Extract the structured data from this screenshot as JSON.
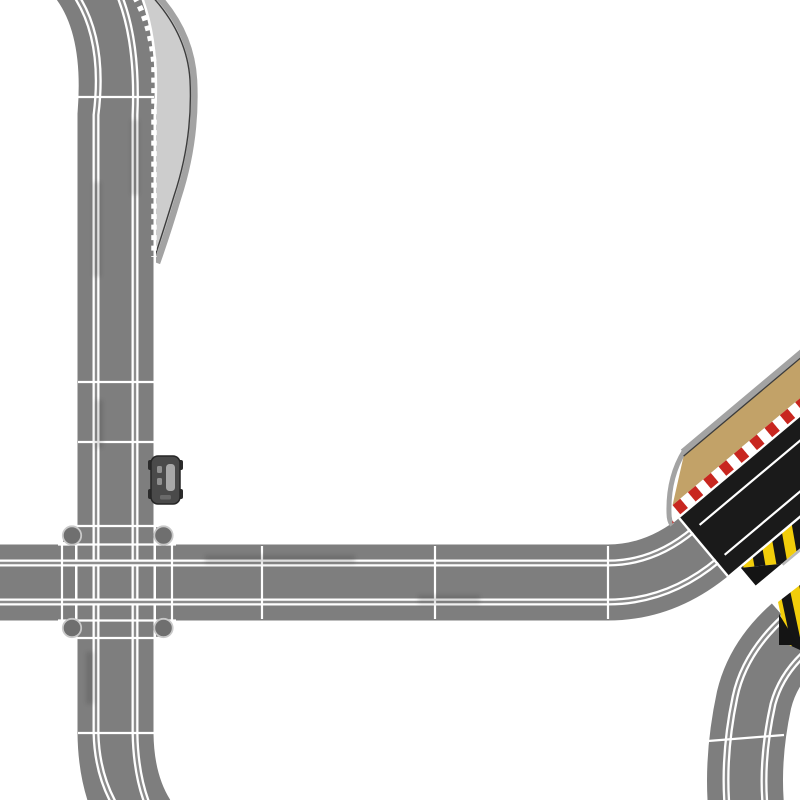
{
  "scene": {
    "description": "Top-down view of a slot car racing track layout on a white background",
    "background_color": "#ffffff"
  },
  "colors": {
    "track_surface": "#7e7e7e",
    "track_edge_and_slots": "#ffffff",
    "slot_center": "#8d8d8d",
    "apron_fill": "#cdcdcd",
    "apron_rim": "#a3a3a3",
    "apron_edge_line": "#3c3c3c",
    "crossover_post": "#6f6f6f",
    "crossover_post_ring": "#c9c9c9",
    "ramp_surface": "#1a1a1a",
    "ramp_side_tan": "#c2a268",
    "curb_red": "#c8261f",
    "curb_white": "#ffffff",
    "hazard_yellow": "#f2cd0a",
    "hazard_black": "#151515",
    "car_body": "#4a4a4a",
    "car_detail": "#a8a8a8"
  },
  "elements": [
    {
      "name": "top-left-curve",
      "description": "Grey two-lane track curving from the top edge into the left vertical straight"
    },
    {
      "name": "left-vertical-straight",
      "description": "Long grey two-lane straight running down the left side"
    },
    {
      "name": "side-apron",
      "description": "Light grey tapering border apron with dashed white curb line along the upper left straight"
    },
    {
      "name": "crossover-square",
      "description": "Square 90-degree crossover piece with four round corner posts"
    },
    {
      "name": "horizontal-straight",
      "description": "Grey two-lane straight crossing the layout from the left edge toward the right"
    },
    {
      "name": "right-up-curve",
      "description": "Curve bending the horizontal straight up toward the leap ramp"
    },
    {
      "name": "leap-takeoff-ramp",
      "description": "Black diagonal leap take-off ramp with tan side, red/white curb and yellow/black hazard edge"
    },
    {
      "name": "leap-landing-ramp",
      "description": "Partially visible landing ramp tip with yellow/black hazard stripes at the right edge"
    },
    {
      "name": "bottom-right-s-curve",
      "description": "Grey two-lane S-curve leaving the landing ramp toward the bottom edge"
    },
    {
      "name": "bottom-left-curve",
      "description": "Grey two-lane curve exiting the bottom edge at lower left"
    },
    {
      "name": "parked-slot-car",
      "description": "Small dark slot car standing on the right edge of the left straight"
    }
  ]
}
